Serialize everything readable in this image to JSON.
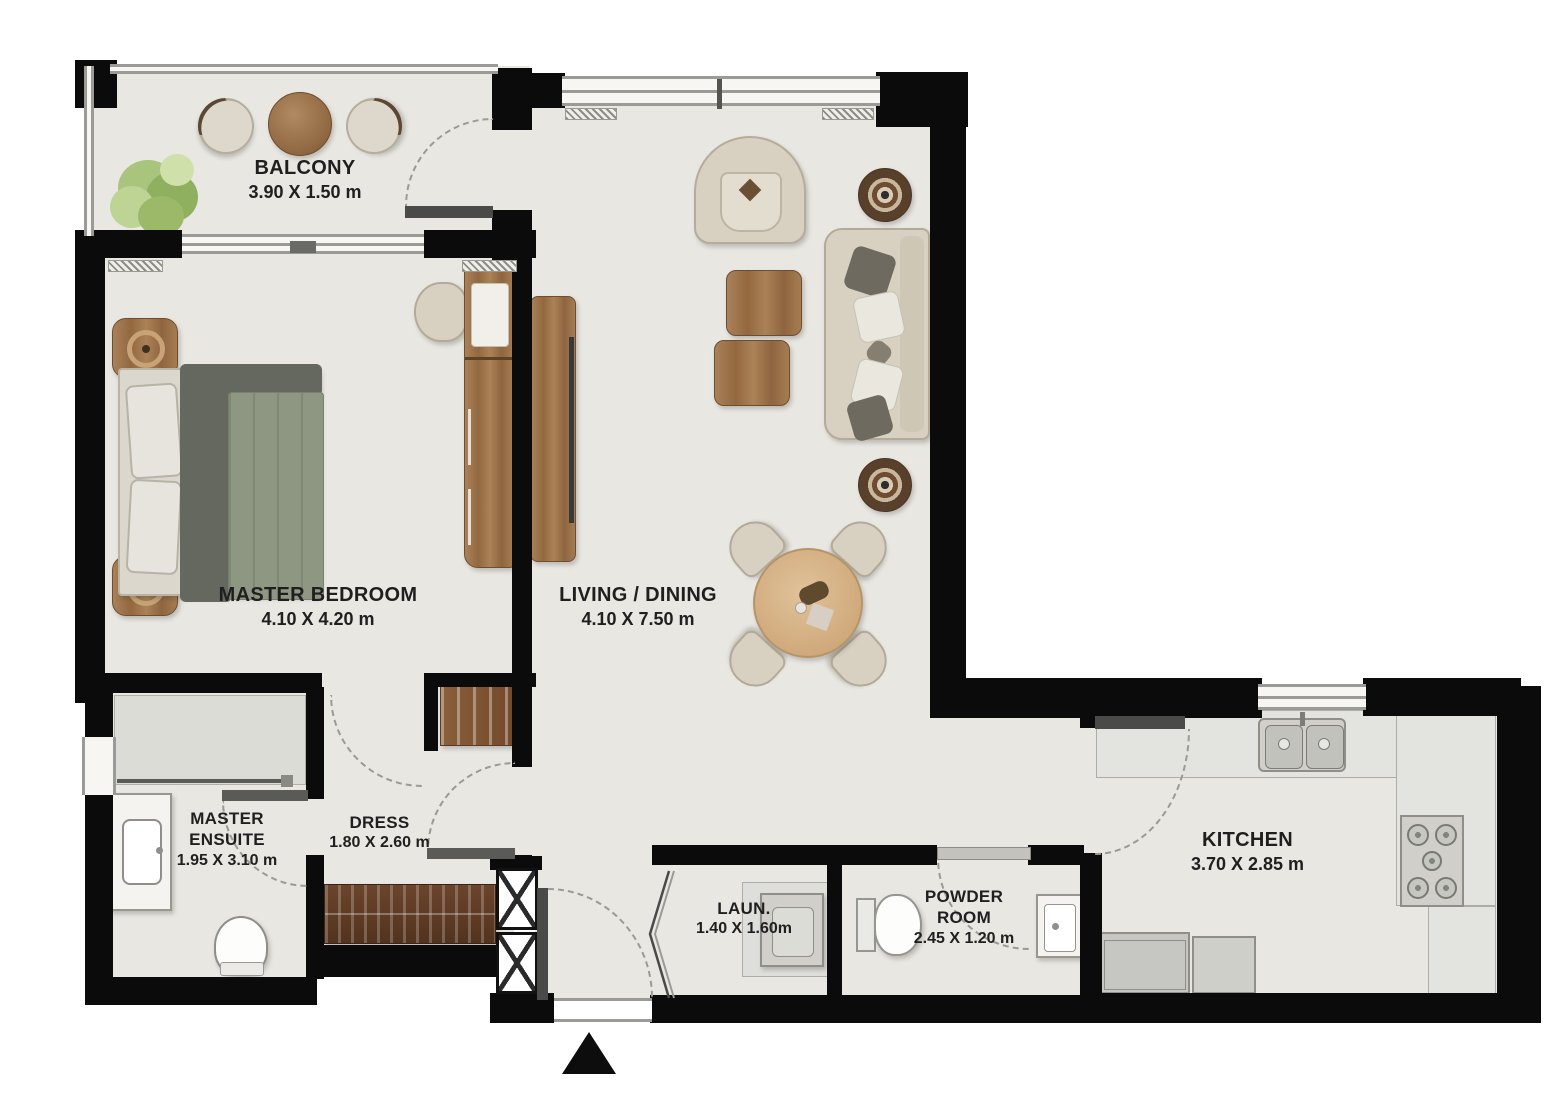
{
  "plan": {
    "rooms": {
      "balcony": {
        "label": "BALCONY",
        "dims": "3.90 X 1.50 m"
      },
      "master_bedroom": {
        "label": "MASTER BEDROOM",
        "dims": "4.10 X 4.20 m"
      },
      "living_dining": {
        "label": "LIVING / DINING",
        "dims": "4.10 X 7.50 m"
      },
      "master_ensuite": {
        "label": "MASTER ENSUITE",
        "dims": "1.95 X 3.10 m"
      },
      "dress": {
        "label": "DRESS",
        "dims": "1.80 X 2.60 m"
      },
      "laundry": {
        "label": "LAUN.",
        "dims": "1.40 X 1.60m"
      },
      "powder_room": {
        "label": "POWDER ROOM",
        "dims": "2.45 X 1.20 m"
      },
      "kitchen": {
        "label": "KITCHEN",
        "dims": "3.70 X 2.85 m"
      }
    },
    "colors": {
      "wall": "#0b0b0b",
      "floor": "#e9e7e2",
      "wood": "#a07a52",
      "dark_wood": "#5c3b29",
      "plant_green": "#aec87f",
      "text": "#1f1f1f"
    }
  }
}
